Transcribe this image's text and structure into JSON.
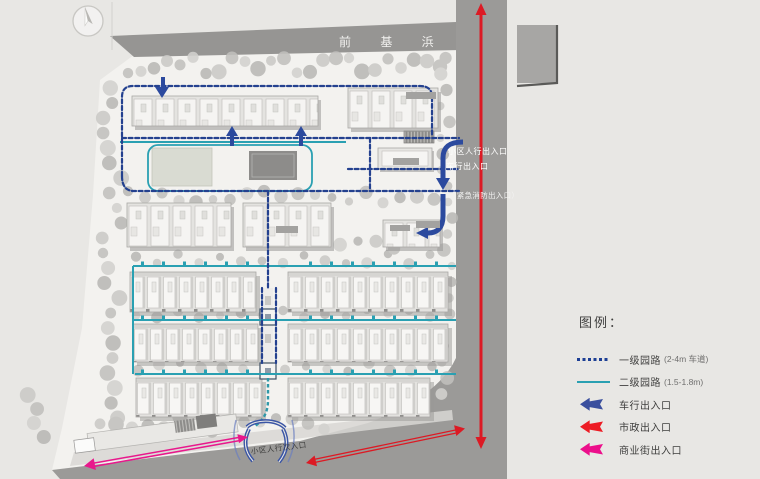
{
  "site_plan": {
    "river_label": "前 基 浜",
    "entrances": {
      "pedestrian_main": "小区人行出入口",
      "vehicle": "车行出入口",
      "emergency": "（紧急消防出入口）",
      "pedestrian_secondary": "小区人行次入口"
    }
  },
  "legend": {
    "title": "图例：",
    "items": [
      {
        "label": "一级园路",
        "note": "(2-4m 车道)",
        "swatch": "dashed-line",
        "color": "#1d3f94"
      },
      {
        "label": "二级园路",
        "note": "(1.5-1.8m)",
        "swatch": "solid-line",
        "color": "#2aa0b2"
      },
      {
        "label": "车行出入口",
        "note": "",
        "swatch": "arrow-left",
        "color": "#3a4f9e"
      },
      {
        "label": "市政出入口",
        "note": "",
        "swatch": "arrow-left",
        "color": "#ed1c24"
      },
      {
        "label": "商业街出入口",
        "note": "",
        "swatch": "arrow-left",
        "color": "#ec0f8b"
      }
    ]
  },
  "colors": {
    "background": "#e8e7e4",
    "road": "#9b9a98",
    "primary_path": "#1d3f94",
    "secondary_path": "#2aa0b2",
    "vehicle_arrow": "#3a4f9e",
    "municipal_arrow": "#ed1c24",
    "commercial_arrow": "#ec0f8b"
  }
}
